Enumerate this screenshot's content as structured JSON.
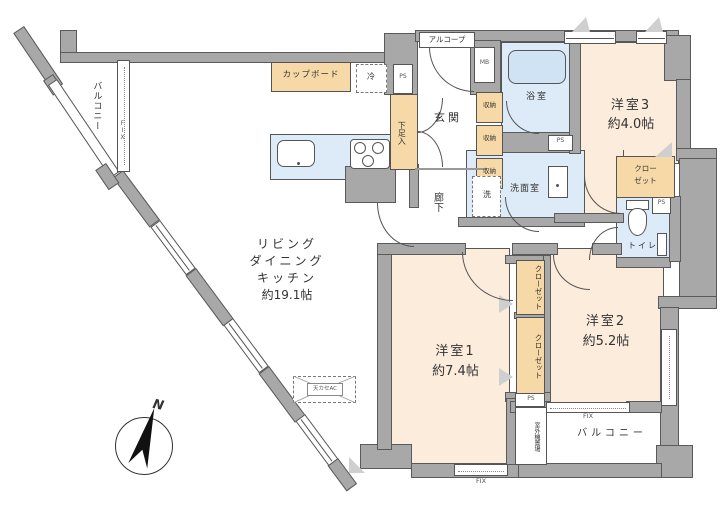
{
  "floorplan": {
    "rooms": {
      "ldk": {
        "name_lines": "リビング\nダイニング\nキッチン",
        "size": "約19.1帖"
      },
      "bedroom1": {
        "name": "洋室1",
        "size": "約7.4帖"
      },
      "bedroom2": {
        "name": "洋室2",
        "size": "約5.2帖"
      },
      "bedroom3": {
        "name": "洋室3",
        "size": "約4.0帖"
      },
      "entrance": {
        "name": "玄関"
      },
      "corridor": {
        "name": "廊下"
      },
      "bathroom": {
        "name": "浴室"
      },
      "washroom": {
        "name": "洗面室"
      },
      "toilet": {
        "name": "トイレ"
      },
      "alcove": {
        "name": "アルコープ"
      },
      "balcony_left": {
        "name": "バルコニー"
      },
      "balcony_bottom": {
        "name": "バルコニー"
      }
    },
    "features": {
      "cupboard": "カップボード",
      "fridge": "冷",
      "washer": "洗",
      "shoe_cabinet": "下足入",
      "storage": "収納",
      "closet": "クローゼット",
      "closet_wrapped": "クロー\nゼット",
      "ceiling_ac": "天カセAC",
      "outdoor_unit": "室外機置場",
      "meter_box": "MB",
      "pipe_space": "PS",
      "fixed_window": "FIX"
    },
    "compass": {
      "north": "N"
    },
    "colors": {
      "wall": "#a8a8a8",
      "room": "#fcecdc",
      "wet_area": "#dcebf7",
      "storage": "#f7d9a8"
    }
  }
}
